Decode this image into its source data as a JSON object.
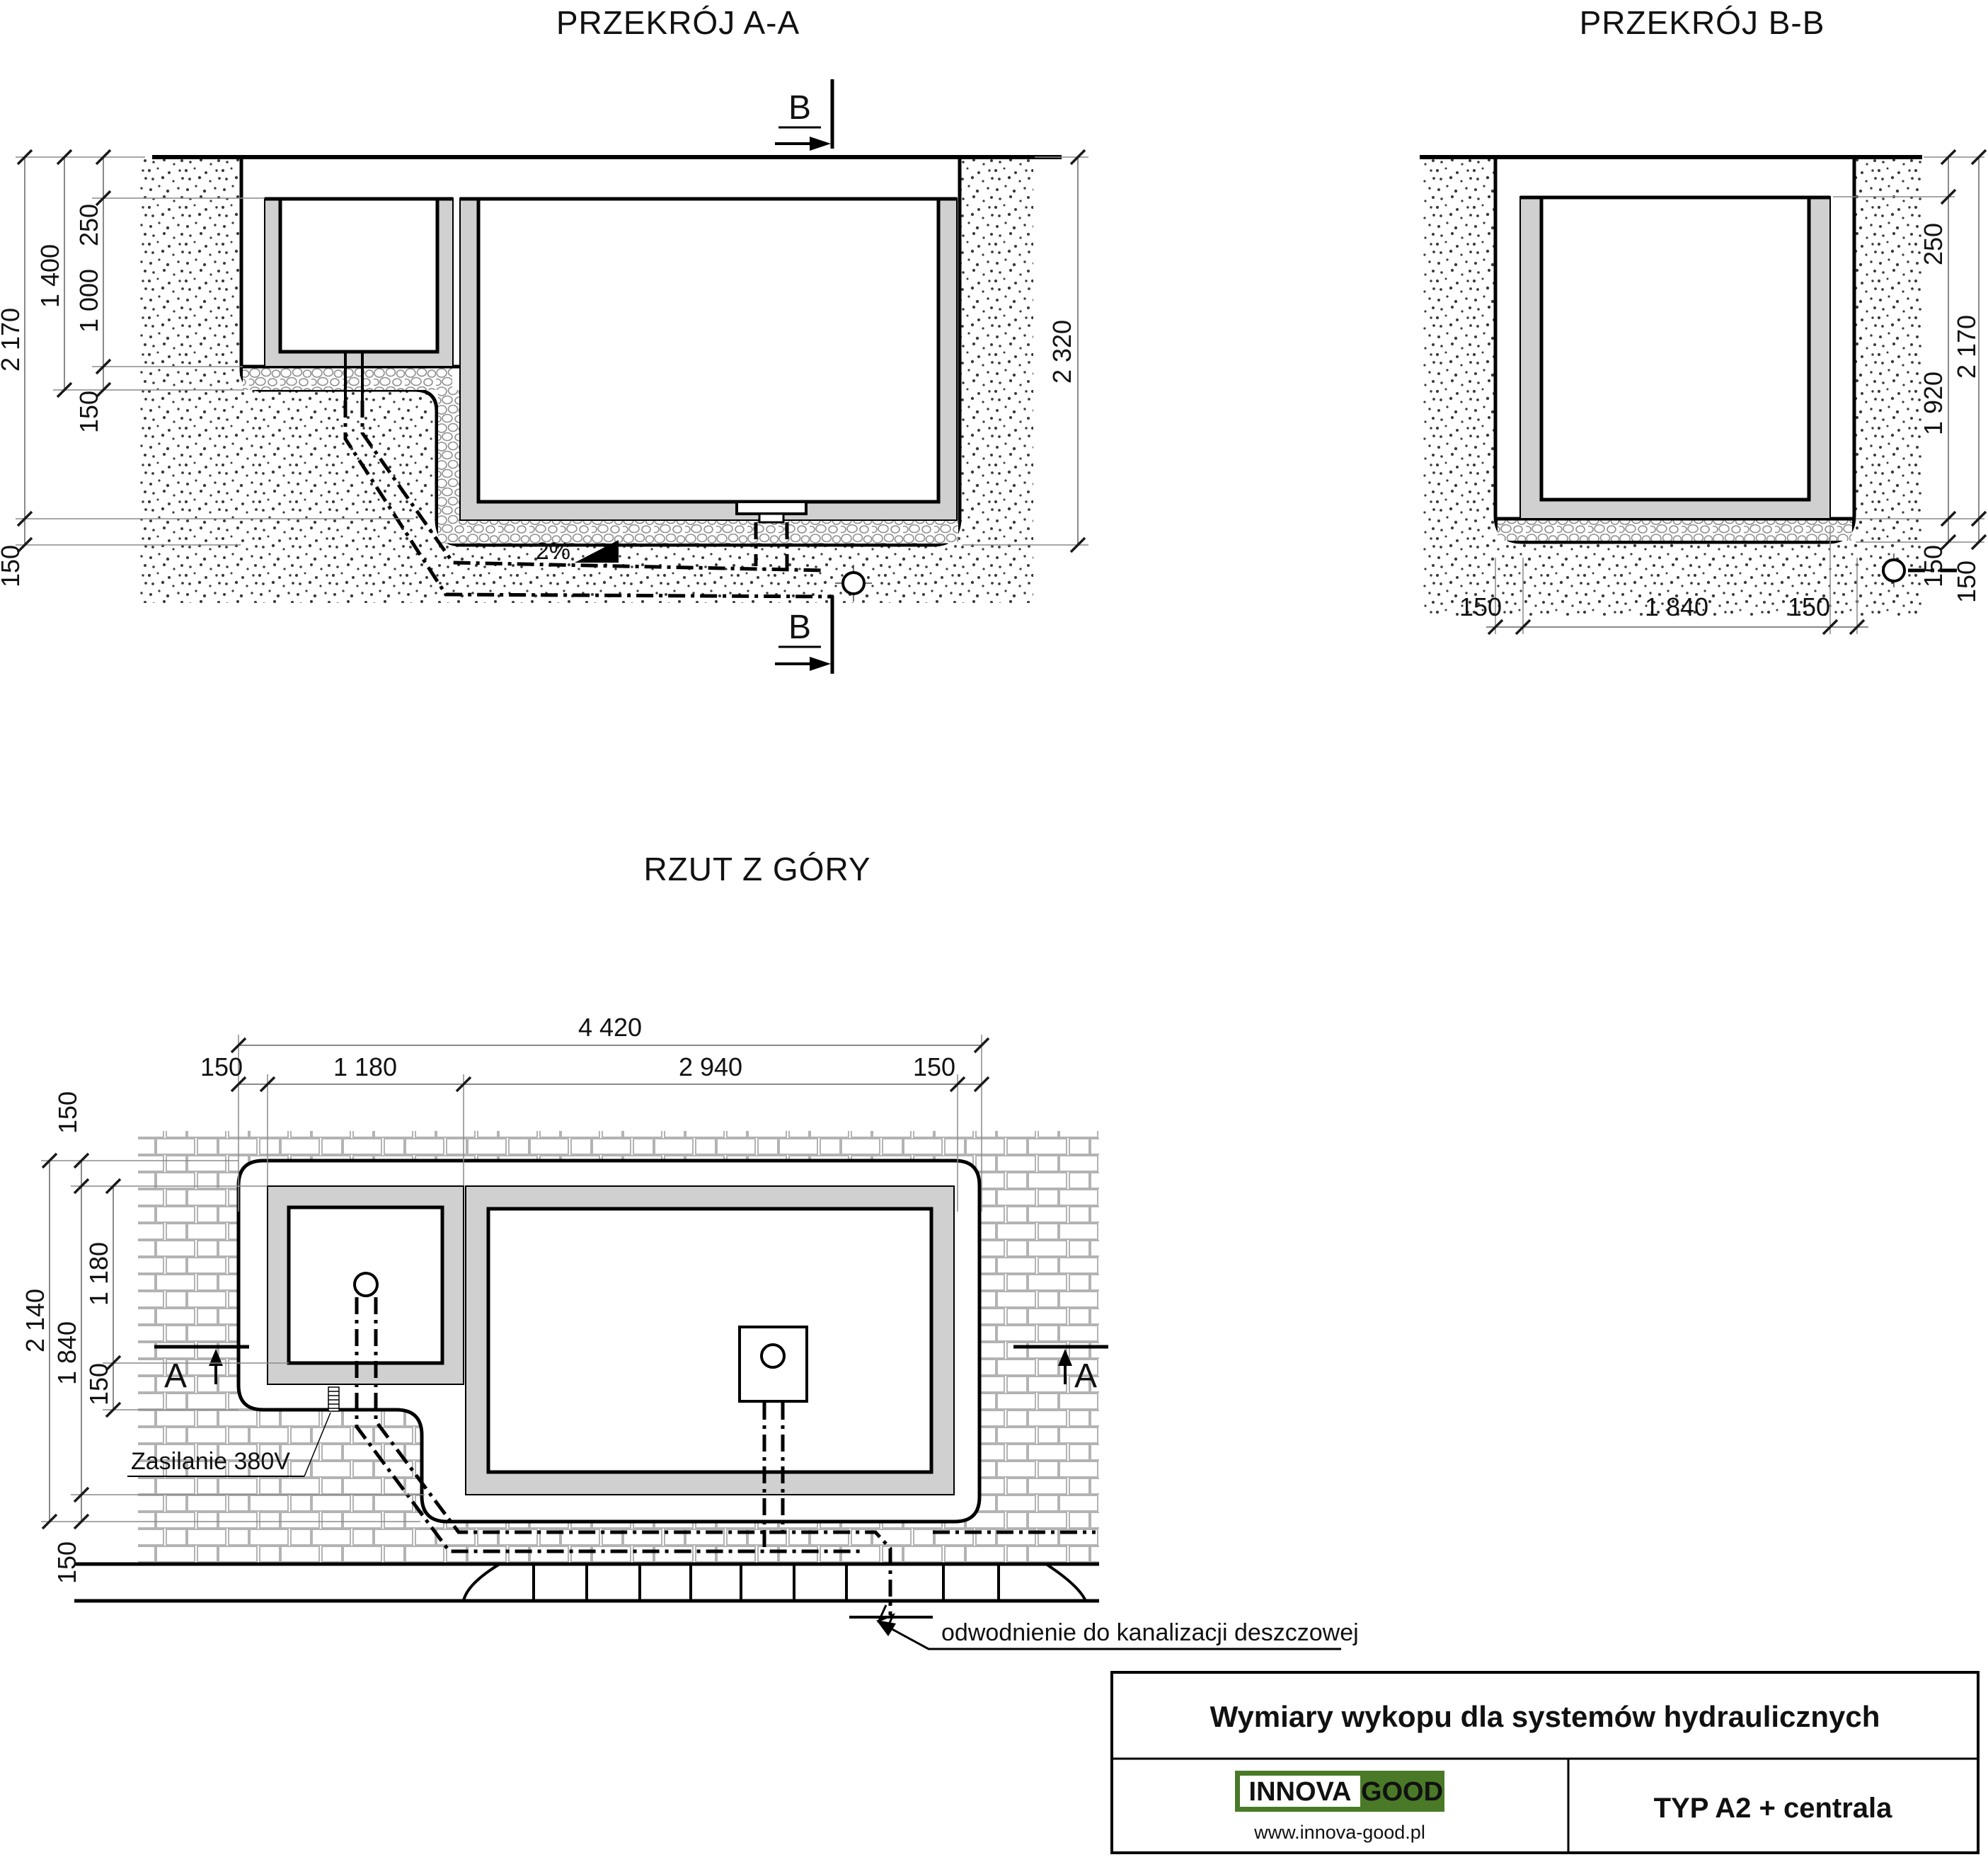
{
  "section_aa": {
    "title": "PRZEKRÓJ A-A",
    "marker_label": "B",
    "slope_label": "2%",
    "dim_250": "250",
    "dim_1000": "1 000",
    "dim_150_gravel": "150",
    "dim_1400": "1 400",
    "dim_2170": "2 170",
    "dim_150_bottom": "150",
    "dim_2320": "2 320"
  },
  "section_bb": {
    "title": "PRZEKRÓJ B-B",
    "dim_250": "250",
    "dim_1920": "1 920",
    "dim_150_inner": "150",
    "dim_2170": "2 170",
    "dim_150_outer": "150",
    "dim_bottom_left": "150",
    "dim_bottom_mid": "1 840",
    "dim_bottom_right": "150"
  },
  "plan": {
    "title": "RZUT Z GÓRY",
    "marker_label": "A",
    "dim_4420": "4 420",
    "dim_150_top_left": "150",
    "dim_1180_top": "1 180",
    "dim_2940": "2 940",
    "dim_150_top_right": "150",
    "dim_150_left_top": "150",
    "dim_2140": "2 140",
    "dim_1840": "1 840",
    "dim_1180_left": "1 180",
    "dim_150_left_mid": "150",
    "dim_150_left_bottom": "150",
    "label_power": "Zasilanie 380V",
    "label_drainage": "odwodnienie do kanalizacji deszczowej"
  },
  "title_block": {
    "title": "Wymiary wykopu dla systemów hydraulicznych",
    "brand_left": "INNOVA",
    "brand_right": "GOOD",
    "website": "www.innova-good.pl",
    "type_label": "TYP A2 + centrala"
  },
  "colors": {
    "brand_green": "#4a7a28",
    "wall_gray": "#d0d0d0"
  }
}
